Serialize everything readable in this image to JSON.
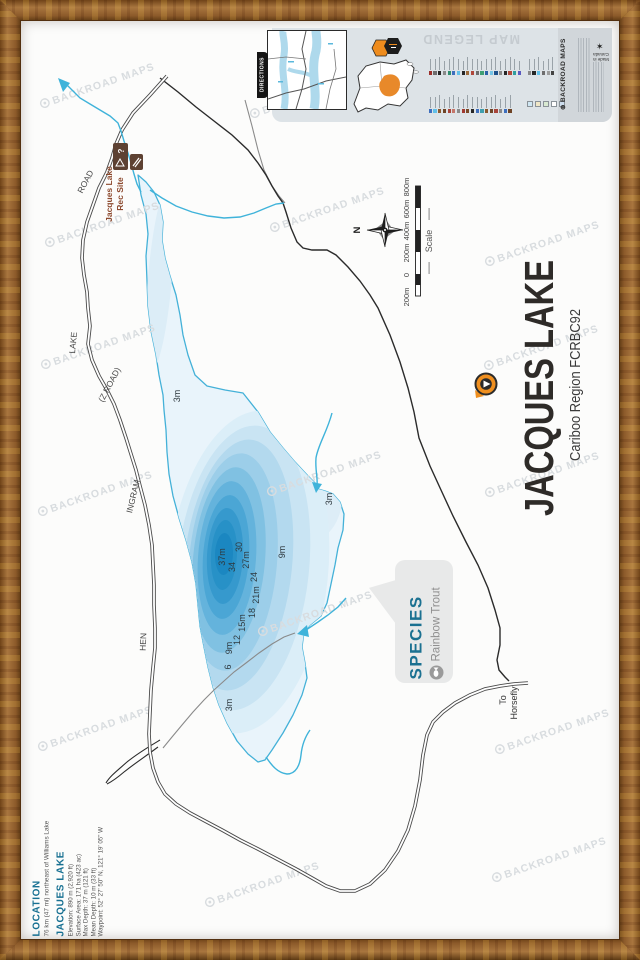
{
  "watermark": {
    "text": "BACKROAD MAPS",
    "color": "#d8dcdf"
  },
  "legend_strip": {
    "directions_tab": "DIRECTIONS",
    "map_legend_title": "MAP LEGEND",
    "brand": "BACKROAD MAPS",
    "made_in": "Made in Canada",
    "strip_bg": "#dde3e7",
    "region_badge_color": "#ee8c1e",
    "symbol_colors_row1": [
      "#9c2f2a",
      "#6e6e6e",
      "#262626",
      "#8a8a8a",
      "#2f8f6f",
      "#3e6fbe",
      "#62c0e8",
      "#262626",
      "#9c6a3a",
      "#b0483c",
      "#6e6e6e",
      "#3f9f74",
      "#2a62a8",
      "#74c4e6",
      "#1c4f8a",
      "#8a8a8a",
      "#262626",
      "#b0483c",
      "#2f9f9f",
      "#5a5ac0"
    ],
    "symbol_colors_row1b": [
      "#8a8a8a",
      "#262626",
      "#62c0e8",
      "#6e6e6e",
      "#9c9c9c",
      "#444444"
    ],
    "symbol_colors_row2": [
      "#3e6fbe",
      "#62c0e8",
      "#8a5a2e",
      "#6e4426",
      "#a8453a",
      "#c4766a",
      "#8a8a8a",
      "#a03a30",
      "#7a4a28",
      "#262626",
      "#3e6fbe",
      "#3f9fae",
      "#8a5a2e",
      "#6e4426",
      "#a8453a",
      "#8a8a8a",
      "#3e6fbe",
      "#6e4426"
    ],
    "area_swatches": [
      "#cfe7f3",
      "#efe6c6",
      "#d8e9d1",
      "#ffffff",
      "#cddded"
    ]
  },
  "title_block": {
    "title": "JACQUES LAKE",
    "subtitle": "Cariboo Region FCRBC92",
    "pin_color": "#ef8f1f",
    "title_color": "#2e2b28"
  },
  "location_block": {
    "heading": "LOCATION",
    "description": "76 km (47 mi) northeast of Williams Lake",
    "lake_heading": "JACQUES LAKE",
    "accent_color": "#177092",
    "stats": [
      "Elevation: 890 m (2,920 ft)",
      "Surface Area: 171 ha (423 ac)",
      "Max Depth: 37 m (121 ft)",
      "Mean Depth: 10 m (33 ft)",
      "Waypoint: 52° 27' 50\" N, 121° 19' 05\" W"
    ]
  },
  "species_callout": {
    "heading": "SPECIES",
    "species": "Rainbow Trout",
    "accent_color": "#1b7191"
  },
  "scale_bar": {
    "labels": [
      "800m",
      "600m",
      "400m",
      "200m",
      "0",
      "200m"
    ],
    "caption": "Scale"
  },
  "compass": {
    "north_label": "N"
  },
  "map_labels": {
    "road_names": [
      "ROAD",
      "LAKE",
      "(Z ROAD)",
      "INGRAM",
      "HEN"
    ],
    "destination": [
      "To",
      "Horsefly"
    ],
    "rec_site": [
      "Jacques Lake",
      "Rec Site"
    ]
  },
  "depth_labels": [
    "3m",
    "37m",
    "34",
    "30",
    "27m",
    "24",
    "21m",
    "18",
    "15m",
    "12",
    "9m",
    "6",
    "3m",
    "9m",
    "3m"
  ],
  "lake": {
    "shoreline_color": "#44b1d8",
    "shallow_color": "#e9f4fb",
    "deep_color": "#1b87c1"
  }
}
